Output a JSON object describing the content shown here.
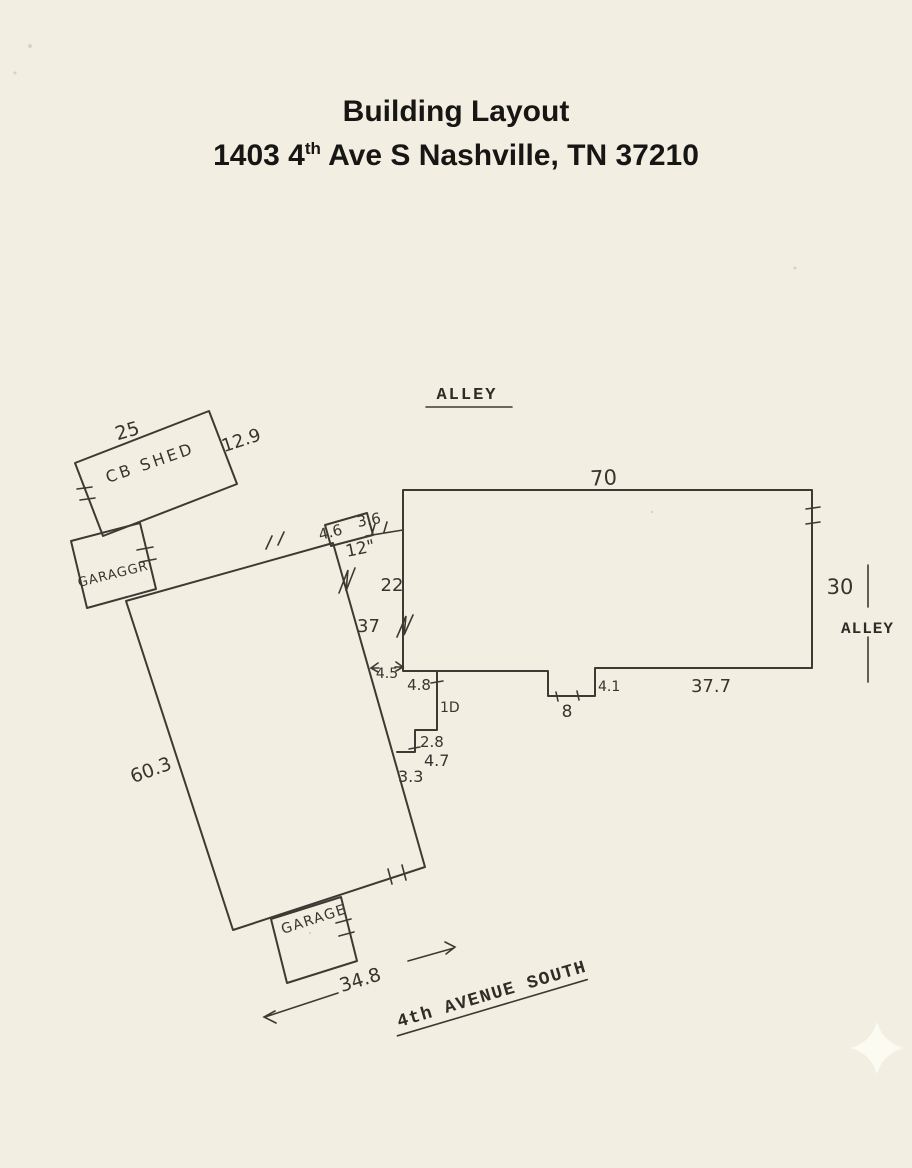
{
  "title": {
    "line1": "Building Layout",
    "address_prefix": "1403 4",
    "address_sup": "th",
    "address_suffix": " Ave S Nashville, TN 37210"
  },
  "streets": {
    "alley_top": "ALLEY",
    "alley_right": "ALLEY",
    "avenue": "4th AVENUE SOUTH"
  },
  "structures": {
    "shed_label": "CB SHED",
    "upper_garage_label": "GARAGGR",
    "lower_garage_label": "GARAGE"
  },
  "dimensions": {
    "shed_width": "25",
    "shed_depth": "12.9",
    "main_top": "70",
    "main_right": "30",
    "bump_width": "4.6",
    "bump_gap": "3.6",
    "bump_offset": "12\"",
    "wall_22": "22",
    "wall_37": "37",
    "gap_45": "4.5",
    "porch_48": "4.8",
    "porch_10": "1D",
    "step_28": "2.8",
    "step_47": "4.7",
    "step_33": "3.3",
    "notch_width": "8",
    "notch_41": "4.1",
    "bottom_377": "37.7",
    "house_side": "60.3",
    "house_front": "34.8"
  }
}
